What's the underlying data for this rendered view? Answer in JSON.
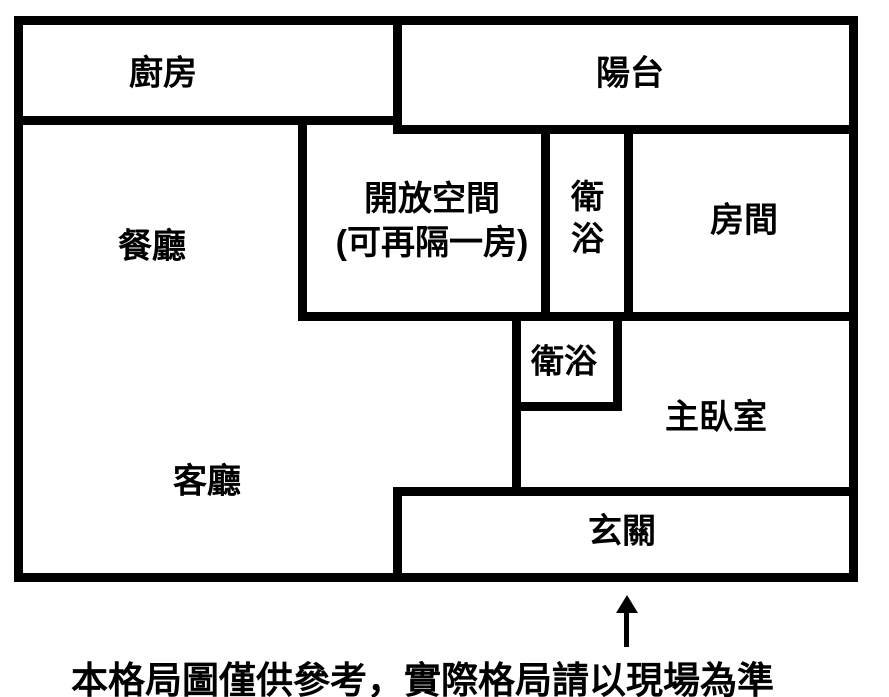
{
  "floor_plan": {
    "colors": {
      "wall": "#000000",
      "background": "#ffffff",
      "text": "#000000"
    },
    "rooms": [
      {
        "id": "kitchen",
        "label": "廚房"
      },
      {
        "id": "balcony",
        "label": "陽台"
      },
      {
        "id": "dining",
        "label": "餐廳"
      },
      {
        "id": "open_space",
        "label": "開放空間",
        "label_line2": "(可再隔一房)"
      },
      {
        "id": "bath_upper",
        "label": "衛浴"
      },
      {
        "id": "room",
        "label": "房間"
      },
      {
        "id": "bath_lower",
        "label": "衛浴"
      },
      {
        "id": "master_bedroom",
        "label": "主臥室"
      },
      {
        "id": "living",
        "label": "客廳"
      },
      {
        "id": "entry",
        "label": "玄關"
      }
    ],
    "entrance_arrow_icon": "up-arrow",
    "caption": "本格局圖僅供參考，實際格局請以現場為準"
  }
}
